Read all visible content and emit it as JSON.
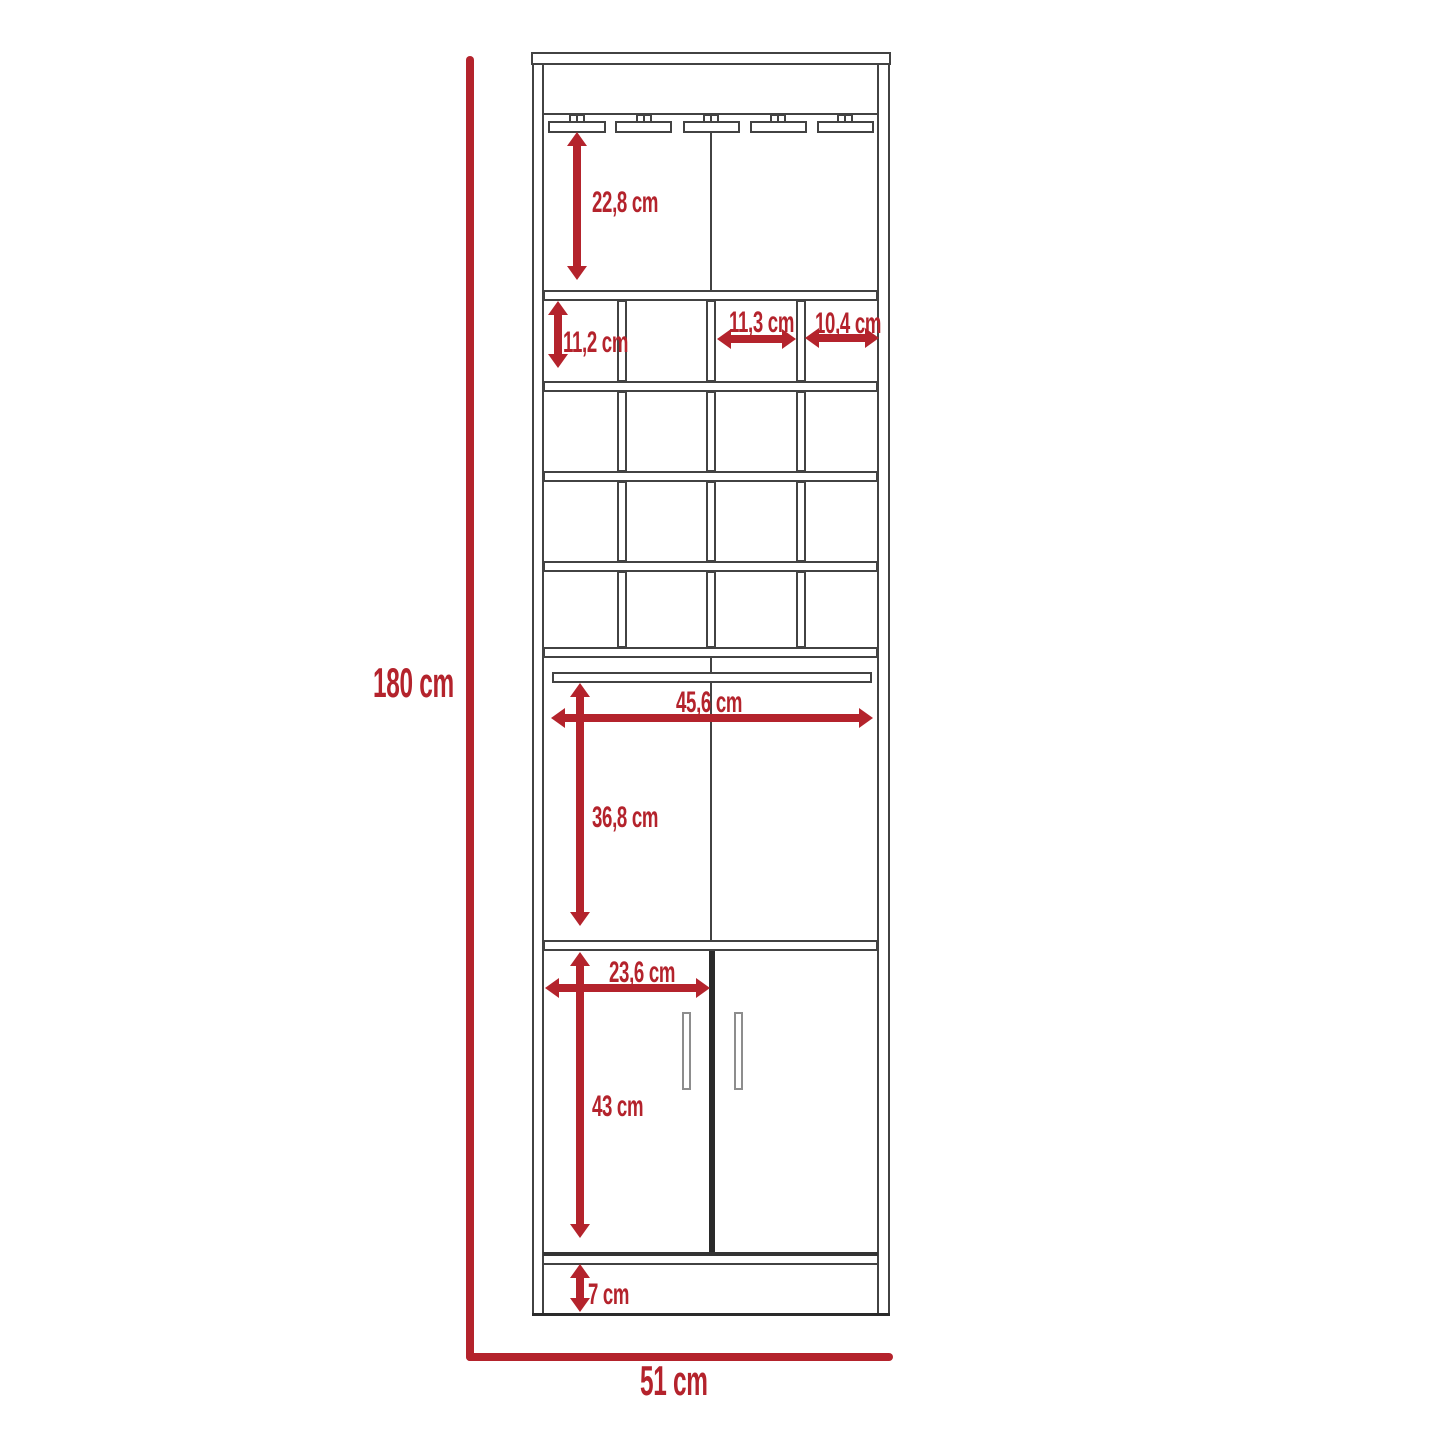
{
  "diagram": {
    "type": "furniture dimension drawing",
    "subject": "tall bar cabinet with stemware rack, wine cubbies, open shelf and two doors",
    "unit": "cm"
  },
  "colors": {
    "accent_red": "#b4232c",
    "line_gray": "#424242"
  },
  "labels": {
    "overall_height": "180 cm",
    "overall_width": "51 cm",
    "stemware_section_height": "22,8 cm",
    "cubby_height": "11,2 cm",
    "cubby_width_third": "11,3 cm",
    "cubby_width_fourth": "10,4 cm",
    "interior_width": "45,6 cm",
    "open_compartment_height": "36,8 cm",
    "door_panel_width": "23,6 cm",
    "door_section_height": "43 cm",
    "plinth_height": "7 cm"
  }
}
